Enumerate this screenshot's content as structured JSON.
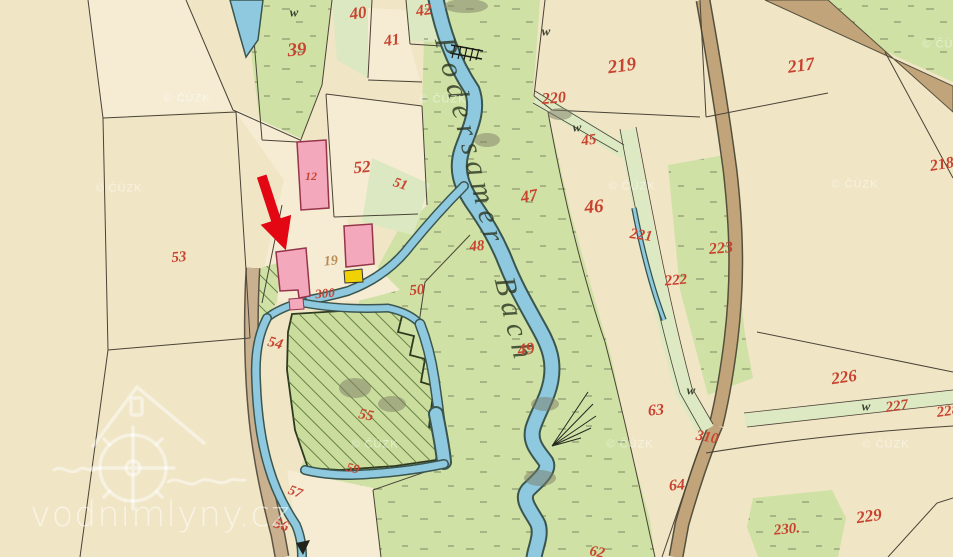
{
  "map": {
    "description": "Historical cadastral map sheet showing a watermill site on a stream, with red parcel numbers and a red arrow annotation",
    "stream_label": "Podersamer Bach",
    "watermark": {
      "site_text": "vodnimlyny.cz",
      "copyright_text": "© ČÚZK",
      "logo": "watermill-house-logo"
    },
    "annotation": {
      "type": "red-arrow",
      "points_to": "pink mill building at the millrace",
      "color": "#e30613"
    },
    "symbols": {
      "meadow_mark": "w"
    },
    "colors": {
      "paper": "#f0e5c5",
      "paper_light": "#f5ecd3",
      "meadow": "#cfe1a4",
      "meadow_pale": "#dce8c1",
      "water": "#8fc9df",
      "water_edge": "#3a564f",
      "road": "#c2a47b",
      "road_light": "#c9b190",
      "building_masonry": "#f3a8bc",
      "building_wood": "#f0d103",
      "number_red": "#c8432f",
      "number_brown": "#b98a54"
    },
    "parcel_labels": [
      {
        "text": "39",
        "x": 297,
        "y": 50,
        "fs": 19,
        "rot": -5
      },
      {
        "text": "40",
        "x": 358,
        "y": 13,
        "fs": 17,
        "rot": -8
      },
      {
        "text": "41",
        "x": 392,
        "y": 41,
        "fs": 16,
        "rot": -8
      },
      {
        "text": "42",
        "x": 424,
        "y": 11,
        "fs": 16,
        "rot": -8
      },
      {
        "text": "219",
        "x": 622,
        "y": 66,
        "fs": 19,
        "rot": -8
      },
      {
        "text": "217",
        "x": 801,
        "y": 65,
        "fs": 18,
        "rot": -8
      },
      {
        "text": "218",
        "x": 942,
        "y": 165,
        "fs": 16,
        "rot": -10
      },
      {
        "text": "220",
        "x": 554,
        "y": 99,
        "fs": 16,
        "rot": -5
      },
      {
        "text": "45",
        "x": 589,
        "y": 141,
        "fs": 15,
        "rot": -8
      },
      {
        "text": "46",
        "x": 594,
        "y": 207,
        "fs": 19,
        "rot": -5
      },
      {
        "text": "47",
        "x": 529,
        "y": 196,
        "fs": 17,
        "rot": -10
      },
      {
        "text": "48",
        "x": 477,
        "y": 247,
        "fs": 15,
        "rot": -5
      },
      {
        "text": "50",
        "x": 417,
        "y": 291,
        "fs": 15,
        "rot": -5
      },
      {
        "text": "49",
        "x": 526,
        "y": 349,
        "fs": 17,
        "rot": -8
      },
      {
        "text": "51",
        "x": 400,
        "y": 185,
        "fs": 14,
        "rot": 18
      },
      {
        "text": "52",
        "x": 362,
        "y": 167,
        "fs": 17,
        "rot": -5
      },
      {
        "text": "12",
        "x": 311,
        "y": 176,
        "fs": 12,
        "rot": 0
      },
      {
        "text": "19",
        "x": 331,
        "y": 262,
        "fs": 14,
        "rot": -5,
        "color": "#b98a54"
      },
      {
        "text": "300",
        "x": 325,
        "y": 293,
        "fs": 13,
        "rot": -5
      },
      {
        "text": "53",
        "x": 179,
        "y": 258,
        "fs": 15,
        "rot": -5
      },
      {
        "text": "54",
        "x": 275,
        "y": 344,
        "fs": 15,
        "rot": 15
      },
      {
        "text": "55",
        "x": 366,
        "y": 416,
        "fs": 15,
        "rot": 12
      },
      {
        "text": "59",
        "x": 353,
        "y": 468,
        "fs": 13,
        "rot": 12
      },
      {
        "text": "57",
        "x": 295,
        "y": 493,
        "fs": 14,
        "rot": 20
      },
      {
        "text": "56",
        "x": 281,
        "y": 526,
        "fs": 15,
        "rot": 18
      },
      {
        "text": "62",
        "x": 597,
        "y": 553,
        "fs": 15,
        "rot": 12
      },
      {
        "text": "63",
        "x": 656,
        "y": 411,
        "fs": 16,
        "rot": -5
      },
      {
        "text": "64",
        "x": 677,
        "y": 486,
        "fs": 16,
        "rot": -5
      },
      {
        "text": "310",
        "x": 707,
        "y": 438,
        "fs": 15,
        "rot": 10
      },
      {
        "text": "221",
        "x": 641,
        "y": 236,
        "fs": 15,
        "rot": 8
      },
      {
        "text": "222",
        "x": 676,
        "y": 281,
        "fs": 15,
        "rot": -5
      },
      {
        "text": "223",
        "x": 721,
        "y": 249,
        "fs": 16,
        "rot": -5
      },
      {
        "text": "226",
        "x": 844,
        "y": 377,
        "fs": 17,
        "rot": -8
      },
      {
        "text": "227",
        "x": 897,
        "y": 407,
        "fs": 15,
        "rot": -8
      },
      {
        "text": "228",
        "x": 948,
        "y": 412,
        "fs": 15,
        "rot": -8
      },
      {
        "text": "229",
        "x": 869,
        "y": 516,
        "fs": 17,
        "rot": -8
      },
      {
        "text": "230.",
        "x": 787,
        "y": 530,
        "fs": 15,
        "rot": -5
      }
    ],
    "meadow_marks": [
      {
        "x": 294,
        "y": 12
      },
      {
        "x": 546,
        "y": 31
      },
      {
        "x": 577,
        "y": 127
      },
      {
        "x": 691,
        "y": 390
      },
      {
        "x": 866,
        "y": 406
      }
    ],
    "copyright_marks": [
      {
        "x": 187,
        "y": 99
      },
      {
        "x": 119,
        "y": 189
      },
      {
        "x": 443,
        "y": 100
      },
      {
        "x": 632,
        "y": 187
      },
      {
        "x": 855,
        "y": 185
      },
      {
        "x": 375,
        "y": 445
      },
      {
        "x": 630,
        "y": 445
      },
      {
        "x": 886,
        "y": 445
      },
      {
        "x": 946,
        "y": 45
      }
    ]
  }
}
